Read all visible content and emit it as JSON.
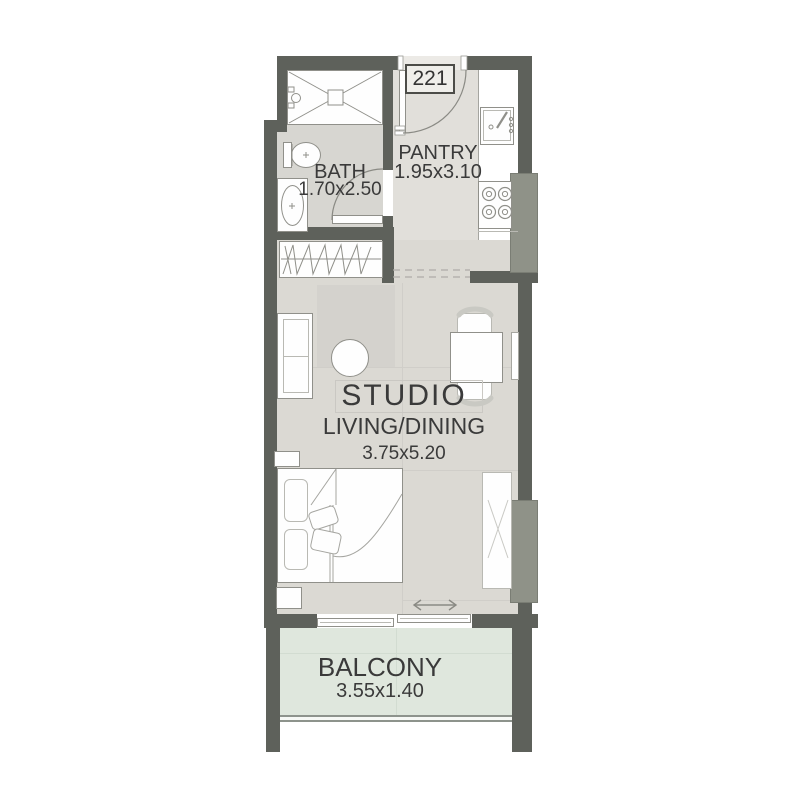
{
  "unit": {
    "number": "221"
  },
  "rooms": {
    "bath": {
      "name": "BATH",
      "dims": "1.70x2.50"
    },
    "pantry": {
      "name": "PANTRY",
      "dims": "1.95x3.10"
    },
    "studio": {
      "name": "STUDIO",
      "subtitle": "LIVING/DINING",
      "dims": "3.75x5.20"
    },
    "balcony": {
      "name": "BALCONY",
      "dims": "3.55x1.40"
    }
  },
  "colors": {
    "wall": "#5e615b",
    "shaft_gray": "#8f9288",
    "living_floor": "#dbd9d3",
    "bath_floor": "#d7d6d1",
    "pantry_floor": "#e1dfda",
    "balcony_floor": "#dfe7dd",
    "furniture_outline": "#90908a",
    "text": "#3a3a3a"
  },
  "symbols": [
    "shower",
    "toilet",
    "washbasin",
    "bath-door",
    "entry-door",
    "hall-wardrobe",
    "kitchen-sink",
    "stove",
    "service-shaft",
    "sofa",
    "coffee-table",
    "dining-table",
    "dining-chairs",
    "window",
    "bed",
    "pillows",
    "nightstands",
    "bedroom-closet",
    "sliding-door",
    "sliding-direction-arrow",
    "balcony-railing"
  ]
}
